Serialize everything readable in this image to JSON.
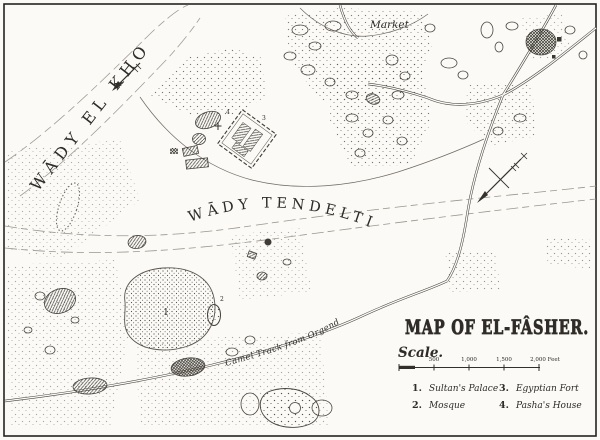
{
  "map": {
    "title": "MAP OF EL-FÂSHER.",
    "scale": {
      "label": "Scale.",
      "ticks": [
        "500",
        "1,000",
        "1,500",
        "2,000 Feet"
      ]
    },
    "legend": {
      "items": [
        {
          "num": "1.",
          "label": "Sultan's Palace"
        },
        {
          "num": "2.",
          "label": "Mosque"
        },
        {
          "num": "3.",
          "label": "Egyptian Fort"
        },
        {
          "num": "4.",
          "label": "Pasha's House"
        }
      ]
    },
    "labels": {
      "wadi_el_kho": "WĀDY EL KHO",
      "wadi_tendelti": "WĀDY TENDELTI",
      "market": "Market",
      "camel_track": "Camel Track from Orgend"
    },
    "markers": {
      "palace": "1",
      "mosque": "2",
      "fort": "3",
      "pashas_house": "4"
    },
    "colors": {
      "ink": "#2e2b28",
      "paper": "#fbfaf6"
    }
  }
}
